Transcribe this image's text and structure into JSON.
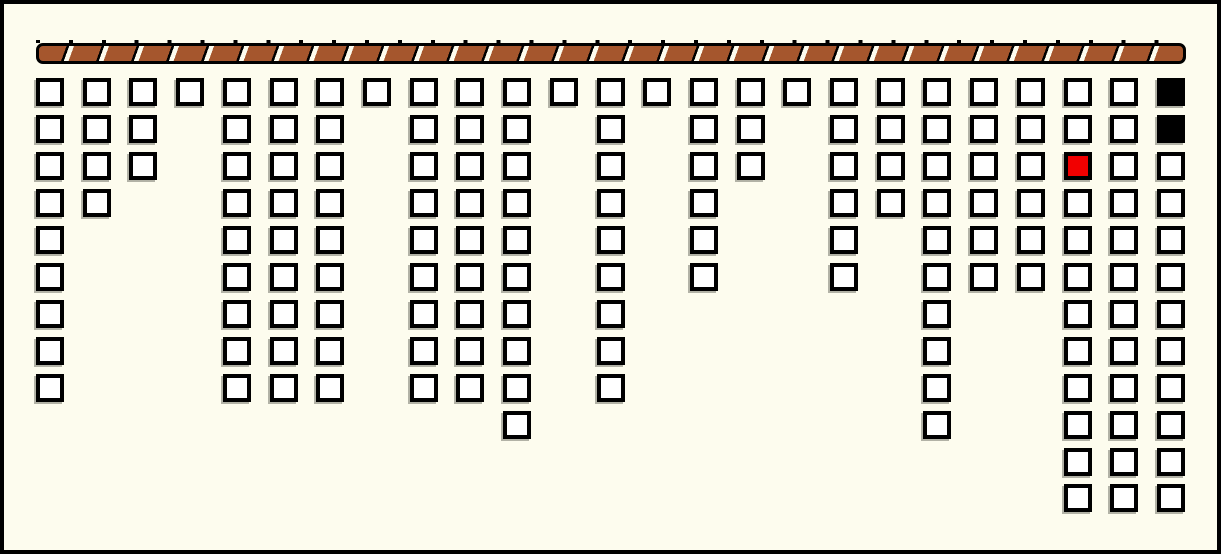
{
  "window": {
    "background": "#fdfcee",
    "border_color": "#000000"
  },
  "rope": {
    "description": "horizontal twisted rope rail with diagonal slash segments",
    "brown": "#a5562d",
    "outline": "#000000",
    "slash_color": "#fdfcee",
    "segment_count": 35
  },
  "board": {
    "num_columns": 25,
    "max_rows": 12,
    "total_tiles": 162,
    "tile_fill": "#ffffff",
    "tile_border": "#000000",
    "tile_shadow": "#b2b2a6",
    "red_tile_color": "#f20000",
    "black_tile_color": "#000000",
    "column_heights": [
      9,
      4,
      3,
      1,
      9,
      9,
      9,
      1,
      9,
      9,
      10,
      1,
      9,
      1,
      6,
      3,
      1,
      6,
      4,
      10,
      6,
      6,
      12,
      12,
      12
    ],
    "special_tiles": [
      {
        "col": 22,
        "row": 2,
        "type": "red"
      },
      {
        "col": 24,
        "row": 0,
        "type": "black"
      },
      {
        "col": 24,
        "row": 1,
        "type": "black"
      }
    ]
  }
}
